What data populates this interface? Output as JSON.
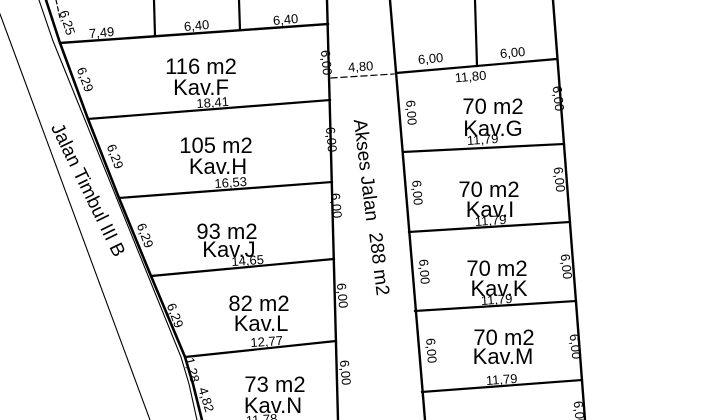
{
  "colors": {
    "ink": "#000000",
    "paper": "#ffffff"
  },
  "roads": {
    "jalan_timbul": {
      "label": "Jalan Timbul III B"
    },
    "akses": {
      "label": "Akses Jalan",
      "area": "288 m2",
      "width_dim": "4,80"
    }
  },
  "top_boundary": {
    "left_segments": [
      "7,49",
      "6,40",
      "6,40"
    ],
    "left_road_frontage": "6,25",
    "right_segments": [
      "6,00",
      "6,00"
    ]
  },
  "left_column": [
    {
      "area": "116 m2",
      "name": "Kav.F",
      "frontage": "6,29",
      "rear": "6,00",
      "bottom": "18,41"
    },
    {
      "area": "105 m2",
      "name": "Kav.H",
      "frontage": "6,29",
      "rear": "6,00",
      "bottom": "16,53"
    },
    {
      "area": "93 m2",
      "name": "Kav.J",
      "frontage": "6,29",
      "rear": "6,00",
      "bottom": "14,65"
    },
    {
      "area": "82 m2",
      "name": "Kav.L",
      "frontage": "6,29",
      "rear": "6,00",
      "bottom": "12,77"
    },
    {
      "area": "73 m2",
      "name": "Kav.N",
      "frontage_upper": "1,28",
      "frontage_lower": "4,82",
      "rear": "6,00",
      "bottom": "11,78"
    }
  ],
  "right_column": [
    {
      "area": "70 m2",
      "name": "Kav.G",
      "top": "11,80",
      "left": "6,00",
      "right": "6,00",
      "bottom": "11,79"
    },
    {
      "area": "70 m2",
      "name": "Kav.I",
      "left": "6,00",
      "right": "6,00",
      "bottom": "11,79"
    },
    {
      "area": "70 m2",
      "name": "Kav.K",
      "left": "6,00",
      "right": "6,00",
      "bottom": "11,79"
    },
    {
      "area": "70 m2",
      "name": "Kav.M",
      "left": "6,00",
      "right": "6,00",
      "bottom": "11,79"
    }
  ],
  "bottom_partial_plot": {
    "right": "6,00"
  }
}
